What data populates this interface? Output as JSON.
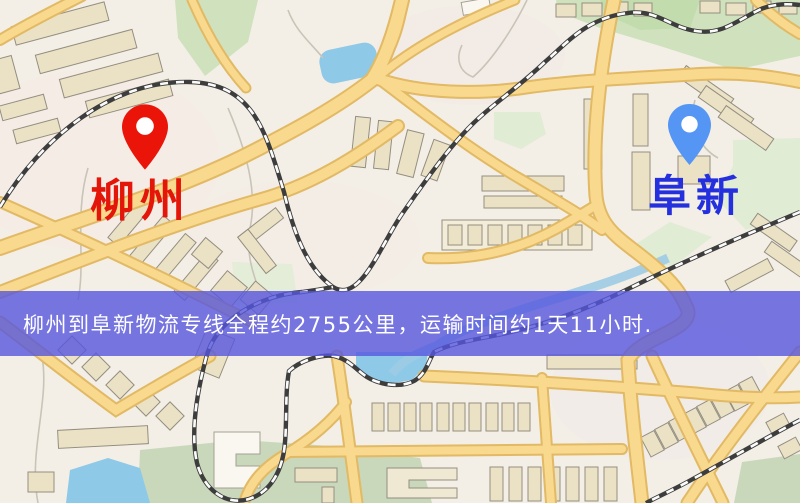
{
  "map": {
    "origin": {
      "label": "柳州",
      "text_color": "#e41509",
      "pin_color": "#ea1508"
    },
    "destination": {
      "label": "阜新",
      "text_color": "#2430dd",
      "pin_color": "#5596f5"
    },
    "banner": {
      "text": "柳州到阜新物流专线全程约2755公里，运输时间约1天11小时.",
      "bg_color": "#5656de",
      "text_color": "#ffffff"
    },
    "map_colors": {
      "background": "#f3efe6",
      "road": "#f8d98e",
      "building": "#ebe2c6",
      "park_green": "#cfe2bd",
      "water_blue": "#8fc9e8",
      "railway": "#3d3d3d"
    }
  }
}
